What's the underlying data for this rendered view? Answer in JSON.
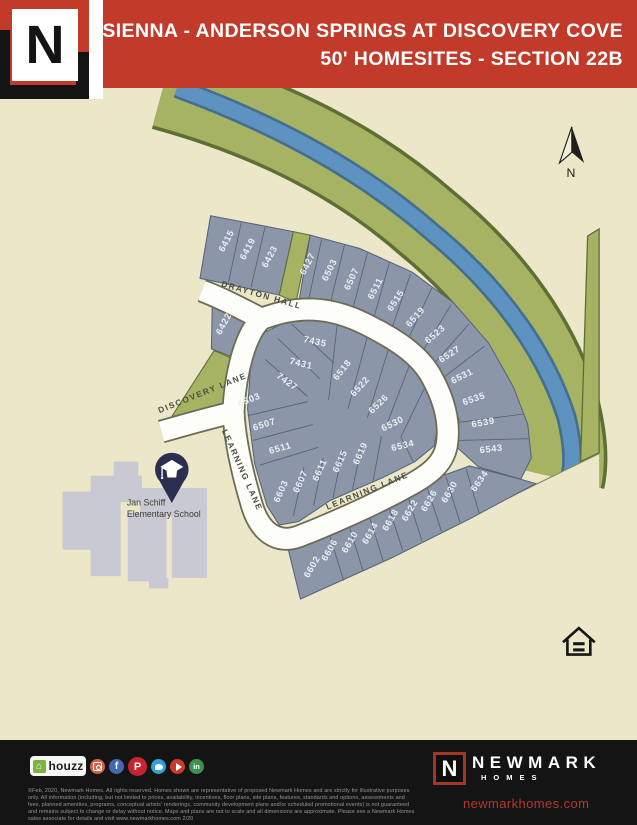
{
  "header": {
    "logo_letter": "N",
    "title_line1": "SIENNA - ANDERSON SPRINGS AT DISCOVERY COVE",
    "title_line2": "50' HOMESITES - SECTION 22B"
  },
  "map": {
    "north_label": "N",
    "school": {
      "name_line1": "Jan Schiff",
      "name_line2": "Elementary School",
      "pin_icon": "graduation-cap"
    },
    "streets": [
      {
        "label": "DRAYTON HALL",
        "x": 253,
        "y": 326,
        "rot": 16
      },
      {
        "label": "DISCOVERY LANE",
        "x": 188,
        "y": 437,
        "rot": -22
      },
      {
        "label": "LEARNING LANE",
        "x": 229,
        "y": 523,
        "rot": 66
      },
      {
        "label": "LEARNING LANE",
        "x": 375,
        "y": 548,
        "rot": -22
      }
    ],
    "lots": [
      {
        "label": "6415",
        "x": 217,
        "y": 263,
        "rot": -62
      },
      {
        "label": "6419",
        "x": 241,
        "y": 272,
        "rot": -62
      },
      {
        "label": "6423",
        "x": 266,
        "y": 281,
        "rot": -62
      },
      {
        "label": "6427",
        "x": 309,
        "y": 289,
        "rot": -63
      },
      {
        "label": "6503",
        "x": 334,
        "y": 296,
        "rot": -64
      },
      {
        "label": "6507",
        "x": 359,
        "y": 306,
        "rot": -65
      },
      {
        "label": "6511",
        "x": 386,
        "y": 317,
        "rot": -63
      },
      {
        "label": "6515",
        "x": 409,
        "y": 331,
        "rot": -57
      },
      {
        "label": "6519",
        "x": 431,
        "y": 350,
        "rot": -49
      },
      {
        "label": "6523",
        "x": 453,
        "y": 370,
        "rot": -41
      },
      {
        "label": "6527",
        "x": 469,
        "y": 393,
        "rot": -33
      },
      {
        "label": "6531",
        "x": 483,
        "y": 418,
        "rot": -27
      },
      {
        "label": "6535",
        "x": 496,
        "y": 444,
        "rot": -19
      },
      {
        "label": "6539",
        "x": 506,
        "y": 471,
        "rot": -10
      },
      {
        "label": "6543",
        "x": 515,
        "y": 501,
        "rot": -7
      },
      {
        "label": "6422",
        "x": 214,
        "y": 357,
        "rot": -62
      },
      {
        "label": "7435",
        "x": 314,
        "y": 379,
        "rot": 12
      },
      {
        "label": "7431",
        "x": 298,
        "y": 404,
        "rot": 14
      },
      {
        "label": "7427",
        "x": 281,
        "y": 424,
        "rot": 36
      },
      {
        "label": "6518",
        "x": 348,
        "y": 410,
        "rot": -52
      },
      {
        "label": "6522",
        "x": 368,
        "y": 429,
        "rot": -48
      },
      {
        "label": "6526",
        "x": 389,
        "y": 449,
        "rot": -44
      },
      {
        "label": "6530",
        "x": 404,
        "y": 472,
        "rot": -26
      },
      {
        "label": "6534",
        "x": 415,
        "y": 497,
        "rot": -14
      },
      {
        "label": "6503",
        "x": 241,
        "y": 445,
        "rot": -22
      },
      {
        "label": "6507",
        "x": 258,
        "y": 473,
        "rot": -18
      },
      {
        "label": "6511",
        "x": 276,
        "y": 500,
        "rot": -16
      },
      {
        "label": "6603",
        "x": 279,
        "y": 547,
        "rot": -66
      },
      {
        "label": "6607",
        "x": 301,
        "y": 536,
        "rot": -66
      },
      {
        "label": "6611",
        "x": 323,
        "y": 523,
        "rot": -66
      },
      {
        "label": "6615",
        "x": 346,
        "y": 513,
        "rot": -66
      },
      {
        "label": "6619",
        "x": 369,
        "y": 504,
        "rot": -66
      },
      {
        "label": "6602",
        "x": 314,
        "y": 633,
        "rot": -60
      },
      {
        "label": "6606",
        "x": 334,
        "y": 614,
        "rot": -60
      },
      {
        "label": "6610",
        "x": 357,
        "y": 605,
        "rot": -60
      },
      {
        "label": "6614",
        "x": 380,
        "y": 595,
        "rot": -60
      },
      {
        "label": "6618",
        "x": 403,
        "y": 580,
        "rot": -60
      },
      {
        "label": "6622",
        "x": 425,
        "y": 569,
        "rot": -60
      },
      {
        "label": "6626",
        "x": 447,
        "y": 558,
        "rot": -60
      },
      {
        "label": "6630",
        "x": 470,
        "y": 548,
        "rot": -60
      },
      {
        "label": "6634",
        "x": 504,
        "y": 536,
        "rot": -55
      }
    ]
  },
  "footer": {
    "houzz_glyph": "⌂",
    "houzz_label": "houzz",
    "social": [
      {
        "name": "instagram",
        "glyph": ""
      },
      {
        "name": "facebook",
        "glyph": "f"
      },
      {
        "name": "pinterest",
        "glyph": "P"
      },
      {
        "name": "twitter",
        "glyph": ""
      },
      {
        "name": "youtube",
        "glyph": ""
      },
      {
        "name": "linkedin",
        "glyph": "in"
      }
    ],
    "disclaimer": "©Feb, 2020, Newmark Homes. All rights reserved. Homes shown are representative of proposed Newmark Homes and are strictly for illustrative purposes only. All information (including, but not limited to prices, availability, incentives, floor plans, site plans, features, standards and options, assessments and fees, planned amenities, programs, conceptual artists' renderings, community development plans and/or scheduled promotional events) is not guaranteed and remains subject to change or delay without notice. Maps and plans are not to scale and all dimensions are approximate. Please see a Newmark Homes sales associate for details and visit www.newmarkhomes.com 2/20",
    "brand_letter": "N",
    "brand_name": "NEWMARK",
    "brand_sub": "HOMES",
    "website": "newmarkhomes.com"
  },
  "colors": {
    "banner_red": "#c23b2a",
    "map_beige": "#ebe7c8",
    "greenbelt": "#a6b363",
    "river_blue": "#5e92c0",
    "lot_gray": "#8b97a9",
    "street_white": "#fdfdf9",
    "pin_navy": "#2c2e4f",
    "footer_black": "#141414",
    "website_red": "#b5382a"
  }
}
